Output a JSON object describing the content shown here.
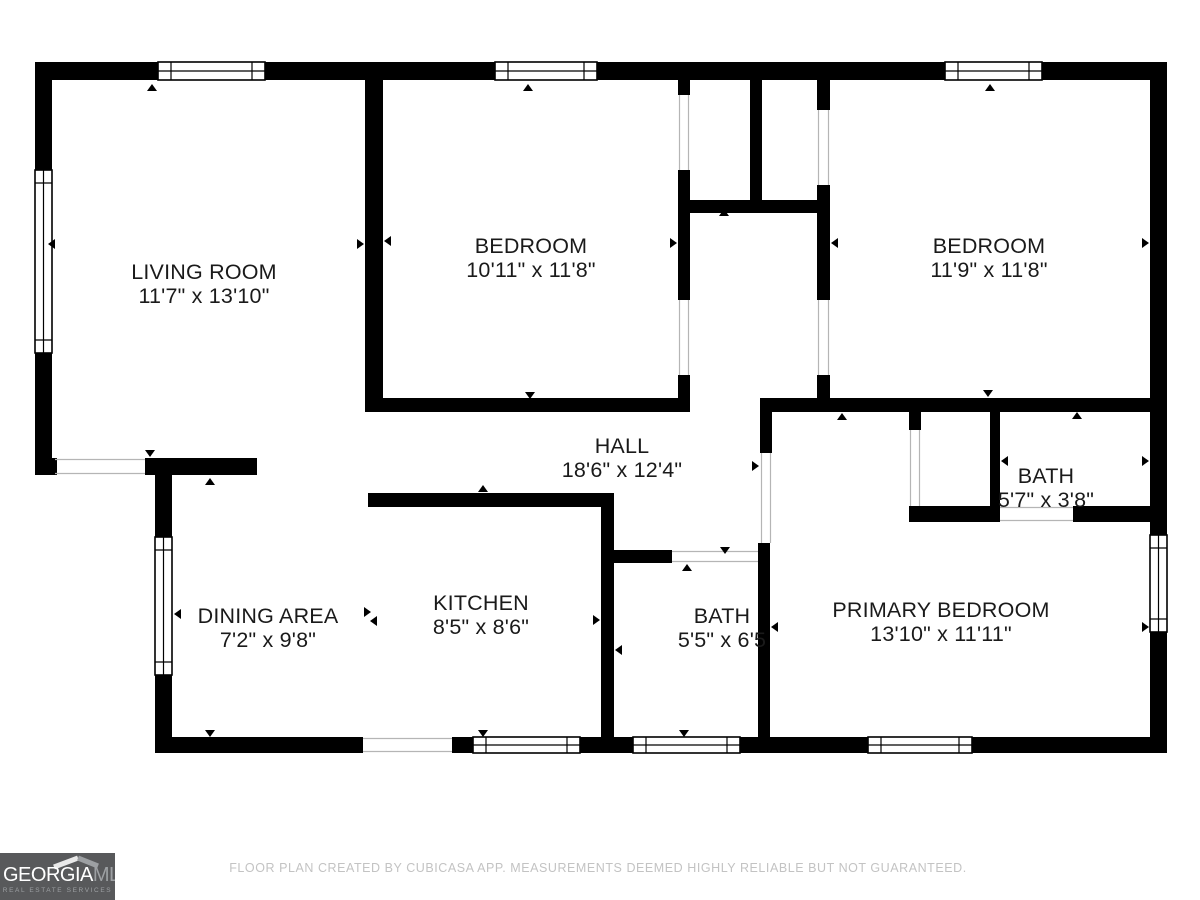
{
  "rooms": [
    {
      "name": "LIVING ROOM",
      "dims": "11'7\" x 13'10\""
    },
    {
      "name": "BEDROOM",
      "dims": "10'11\" x 11'8\""
    },
    {
      "name": "BEDROOM",
      "dims": "11'9\" x 11'8\""
    },
    {
      "name": "HALL",
      "dims": "18'6\" x 12'4\""
    },
    {
      "name": "BATH",
      "dims": "5'7\" x 3'8\""
    },
    {
      "name": "PRIMARY BEDROOM",
      "dims": "13'10\" x 11'11\""
    },
    {
      "name": "BATH",
      "dims": "5'5\" x 6'5"
    },
    {
      "name": "KITCHEN",
      "dims": "8'5\" x 8'6\""
    },
    {
      "name": "DINING AREA",
      "dims": "7'2\" x 9'8\""
    }
  ],
  "footer": {
    "disclaimer": "FLOOR PLAN CREATED BY CUBICASA APP. MEASUREMENTS DEEMED HIGHLY RELIABLE BUT NOT GUARANTEED."
  },
  "logo": {
    "brand_primary": "GEORGIA",
    "brand_secondary": "MLS",
    "tagline": "REAL ESTATE SERVICES"
  },
  "colors": {
    "wall_color": "#000000",
    "label_color": "#1a1a1a",
    "opening_color": "#b5b5b5",
    "footer_color": "#c3c3c3",
    "logo_bg": "#58595b",
    "logo_primary": "#ffffff",
    "logo_secondary": "#9da0a3"
  }
}
